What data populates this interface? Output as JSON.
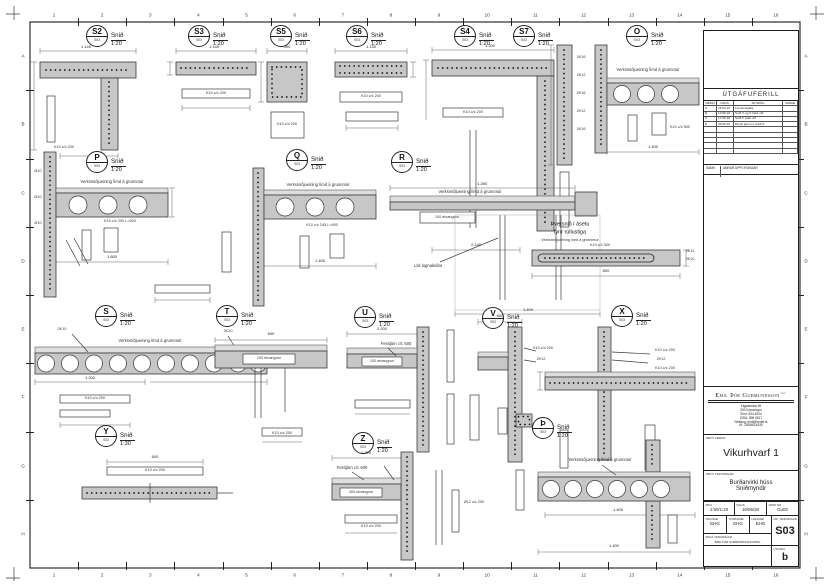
{
  "frame": {
    "columns": [
      "1",
      "2",
      "3",
      "4",
      "5",
      "6",
      "7",
      "8",
      "9",
      "10",
      "11",
      "12",
      "13",
      "14",
      "15",
      "16"
    ],
    "rows": [
      "A",
      "B",
      "C",
      "D",
      "E",
      "F",
      "G",
      "H"
    ]
  },
  "labels": {
    "section_word": "Snið",
    "marker_ref": "S03"
  },
  "details": [
    {
      "letter": "S2",
      "scale": "1:20",
      "x": 97,
      "y": 36
    },
    {
      "letter": "S3",
      "scale": "1:20",
      "x": 199,
      "y": 36
    },
    {
      "letter": "S5",
      "scale": "1:20",
      "x": 281,
      "y": 36
    },
    {
      "letter": "S6",
      "scale": "1:20",
      "x": 357,
      "y": 36
    },
    {
      "letter": "S4",
      "scale": "1:20",
      "x": 465,
      "y": 36
    },
    {
      "letter": "S7",
      "scale": "1:20",
      "x": 524,
      "y": 36
    },
    {
      "letter": "O",
      "scale": "1:20",
      "x": 637,
      "y": 36
    },
    {
      "letter": "P",
      "scale": "1:20",
      "x": 97,
      "y": 162
    },
    {
      "letter": "Q",
      "scale": "1:20",
      "x": 297,
      "y": 160
    },
    {
      "letter": "R",
      "scale": "1:20",
      "x": 402,
      "y": 162
    },
    {
      "letter": "S",
      "scale": "1:20",
      "x": 106,
      "y": 316
    },
    {
      "letter": "T",
      "scale": "1:20",
      "x": 227,
      "y": 316
    },
    {
      "letter": "U",
      "scale": "1:20",
      "x": 365,
      "y": 317
    },
    {
      "letter": "V",
      "scale": "1:20",
      "x": 493,
      "y": 318
    },
    {
      "letter": "X",
      "scale": "1:20",
      "x": 622,
      "y": 316
    },
    {
      "letter": "Y",
      "scale": "1:30",
      "x": 106,
      "y": 436
    },
    {
      "letter": "Z",
      "scale": "1:20",
      "x": 363,
      "y": 443
    },
    {
      "letter": "Þ",
      "scale": "1:20",
      "x": 543,
      "y": 428
    }
  ],
  "annotations": [
    {
      "x": 86,
      "y": 47,
      "t": "1.140",
      "c": "d"
    },
    {
      "x": 64,
      "y": 148,
      "t": "K10 c/c 200",
      "c": "r"
    },
    {
      "x": 214,
      "y": 47,
      "t": "1.140",
      "c": "d"
    },
    {
      "x": 216,
      "y": 93.5,
      "t": "K10 c/c 200",
      "c": "r"
    },
    {
      "x": 287,
      "y": 47,
      "t": "400",
      "c": "d"
    },
    {
      "x": 287,
      "y": 125,
      "t": "K10 c/c 200",
      "c": "r"
    },
    {
      "x": 371,
      "y": 47,
      "t": "1.130",
      "c": "d"
    },
    {
      "x": 371,
      "y": 97,
      "t": "K10 c/c 200",
      "c": "r"
    },
    {
      "x": 490,
      "y": 46,
      "t": "1.200",
      "c": "d"
    },
    {
      "x": 473,
      "y": 112.5,
      "t": "K10 c/c 200",
      "c": "r"
    },
    {
      "x": 476,
      "y": 245,
      "t": "2.140",
      "c": "d"
    },
    {
      "x": 581,
      "y": 58,
      "t": "2K16",
      "c": "r"
    },
    {
      "x": 581,
      "y": 76,
      "t": "2K12",
      "c": "r"
    },
    {
      "x": 581,
      "y": 94,
      "t": "2K16",
      "c": "r"
    },
    {
      "x": 581,
      "y": 112,
      "t": "2K12",
      "c": "r"
    },
    {
      "x": 581,
      "y": 130,
      "t": "2K16",
      "c": "r"
    },
    {
      "x": 648,
      "y": 70,
      "t": "Verksmiðjueining límd á grunnmúr",
      "c": "n"
    },
    {
      "x": 680,
      "y": 128,
      "t": "K10 c/c 500",
      "c": "r"
    },
    {
      "x": 653,
      "y": 147,
      "t": "1.400",
      "c": "d"
    },
    {
      "x": 112,
      "y": 182,
      "t": "Verksmiðjueining límd á grunnmúr",
      "c": "n"
    },
    {
      "x": 120,
      "y": 222,
      "t": "K10 c/c 200 L=900",
      "c": "r"
    },
    {
      "x": 112,
      "y": 257,
      "t": "1.800",
      "c": "d"
    },
    {
      "x": 38,
      "y": 172,
      "t": "Ø10",
      "c": "r"
    },
    {
      "x": 38,
      "y": 198,
      "t": "Ø10",
      "c": "r"
    },
    {
      "x": 38,
      "y": 224,
      "t": "Ø10",
      "c": "r"
    },
    {
      "x": 318,
      "y": 185,
      "t": "Verksmiðjueining límd á grunnmúr",
      "c": "n"
    },
    {
      "x": 322,
      "y": 226,
      "t": "K10 c/c 245 L=900",
      "c": "r"
    },
    {
      "x": 320,
      "y": 261,
      "t": "1.400",
      "c": "d"
    },
    {
      "x": 470,
      "y": 192,
      "t": "Verksmiðjueining límd á grunnmúr",
      "c": "n"
    },
    {
      "x": 482,
      "y": 184,
      "t": "1.280",
      "c": "d"
    },
    {
      "x": 447,
      "y": 217.5,
      "t": "100 einangrun",
      "c": "r"
    },
    {
      "x": 428,
      "y": 266,
      "t": "Lok lagnaleiðar",
      "c": "n"
    },
    {
      "x": 528,
      "y": 310,
      "t": "1.400",
      "c": "d"
    },
    {
      "x": 570,
      "y": 225,
      "t": "Þversnið í ásetu",
      "c": "t"
    },
    {
      "x": 570,
      "y": 233,
      "t": "fyrir rúllustiga",
      "c": "t"
    },
    {
      "x": 570,
      "y": 241,
      "t": "Verksmiðjueining límd á grunnmúr",
      "c": "r"
    },
    {
      "x": 600,
      "y": 246,
      "t": "K10 c/c 300",
      "c": "r"
    },
    {
      "x": 690,
      "y": 252,
      "t": "2K12",
      "c": "r"
    },
    {
      "x": 690,
      "y": 260,
      "t": "2K10",
      "c": "r"
    },
    {
      "x": 606,
      "y": 271,
      "t": "800",
      "c": "d"
    },
    {
      "x": 150,
      "y": 341,
      "t": "Verksmiðjueining límd á grunnmúr",
      "c": "n"
    },
    {
      "x": 62,
      "y": 330,
      "t": "2K10",
      "c": "r"
    },
    {
      "x": 228,
      "y": 332,
      "t": "2K10",
      "c": "r"
    },
    {
      "x": 90,
      "y": 378,
      "t": "1.200",
      "c": "d"
    },
    {
      "x": 95,
      "y": 399,
      "t": "K10 c/c 200",
      "c": "r"
    },
    {
      "x": 271,
      "y": 334,
      "t": "600",
      "c": "d"
    },
    {
      "x": 269,
      "y": 359,
      "t": "100 einangrun",
      "c": "r"
    },
    {
      "x": 282,
      "y": 434,
      "t": "K10 c/c 200",
      "c": "r"
    },
    {
      "x": 382,
      "y": 329,
      "t": "1.200",
      "c": "d"
    },
    {
      "x": 382,
      "y": 361.5,
      "t": "100 einangrun",
      "c": "r"
    },
    {
      "x": 396,
      "y": 344,
      "t": "Festijárn c/c 600",
      "c": "n"
    },
    {
      "x": 500,
      "y": 316,
      "t": "600",
      "c": "d"
    },
    {
      "x": 543,
      "y": 349,
      "t": "K10 c/c 200",
      "c": "r"
    },
    {
      "x": 541,
      "y": 360,
      "t": "2K12",
      "c": "r"
    },
    {
      "x": 665,
      "y": 351,
      "t": "K10 c/c 200",
      "c": "r"
    },
    {
      "x": 661,
      "y": 360,
      "t": "2K12",
      "c": "r"
    },
    {
      "x": 665,
      "y": 369,
      "t": "K10 c/c 200",
      "c": "r"
    },
    {
      "x": 618,
      "y": 510,
      "t": "1.400",
      "c": "d"
    },
    {
      "x": 155,
      "y": 457,
      "t": "600",
      "c": "d"
    },
    {
      "x": 155,
      "y": 471,
      "t": "K10 c/c 200",
      "c": "r"
    },
    {
      "x": 366,
      "y": 453,
      "t": "1.200",
      "c": "d"
    },
    {
      "x": 361,
      "y": 492.5,
      "t": "400 einangrun",
      "c": "r"
    },
    {
      "x": 352,
      "y": 468,
      "t": "Festijárn c/c 600",
      "c": "n"
    },
    {
      "x": 474,
      "y": 503,
      "t": "Ø12 c/c 200",
      "c": "r"
    },
    {
      "x": 600,
      "y": 460,
      "t": "Verksmiðjueining límd á grunnmúr",
      "c": "n"
    },
    {
      "x": 614,
      "y": 546,
      "t": "1.400",
      "c": "d"
    },
    {
      "x": 371,
      "y": 527,
      "t": "K10 c/c 200",
      "c": "r"
    }
  ],
  "title_block": {
    "revision_title": "ÚTGÁFUFERILL",
    "rev_headers": [
      "MERKI",
      "DAGS.",
      "SKÝRING",
      "ANNAÐ"
    ],
    "revisions": [
      {
        "m": "A",
        "d": "25.04.16",
        "t": "Fyrsta útgáfa"
      },
      {
        "m": "B",
        "d": "10.05.16",
        "t": "Snið V og X bætt við"
      },
      {
        "m": "C",
        "d": "17.06.16",
        "t": "Snið Þ bætt við"
      },
      {
        "m": "D",
        "d": "30.06.16",
        "t": "Breytt járnun í sniði S"
      }
    ],
    "approved_label": "SAMÞ.",
    "approved_value": "AÐRAR UPPLÝSINGAR",
    "firm_name": "Emil Þór Guðmundsson",
    "firm_suffix": "ehf.",
    "firm_lines": [
      "Lágasmára 36",
      "200 Kópavogur",
      "Sími: 544 4004",
      "GSM: 898 6517",
      "Netfang: emil@verkfr.is",
      "Kt. 230565-4939"
    ],
    "project_label": "HEITI VERKS:",
    "project_name": "Vikurhvarf 1",
    "drawing_label": "HEITI TEIKNINGAR:",
    "drawing_title1": "Burðarvirki húss",
    "drawing_title2": "Sniðmyndir",
    "scale_label": "MKV.",
    "scale_value": "1:50/1:20",
    "date_label": "DAGS.",
    "date_value": "16/06/30",
    "job_label": "VERK NR.",
    "job_value": "Gu03",
    "drawn_label": "TEIKNAÐ",
    "drawn_value": "EHG",
    "checked_label": "YFIRFARIÐ",
    "checked_value": "EHG",
    "designed_label": "HANNAÐ",
    "designed_value": "EHG",
    "number_label": "NR. TEIKNINGAR",
    "number_value": "S03",
    "file_label": "SKRÁ TEIKNINGAR",
    "file_value": "EMIL ÞÓR GUÐMUNDSSON.DWG",
    "issue_label": "ÚTGÁFA",
    "issue_value": "b"
  }
}
